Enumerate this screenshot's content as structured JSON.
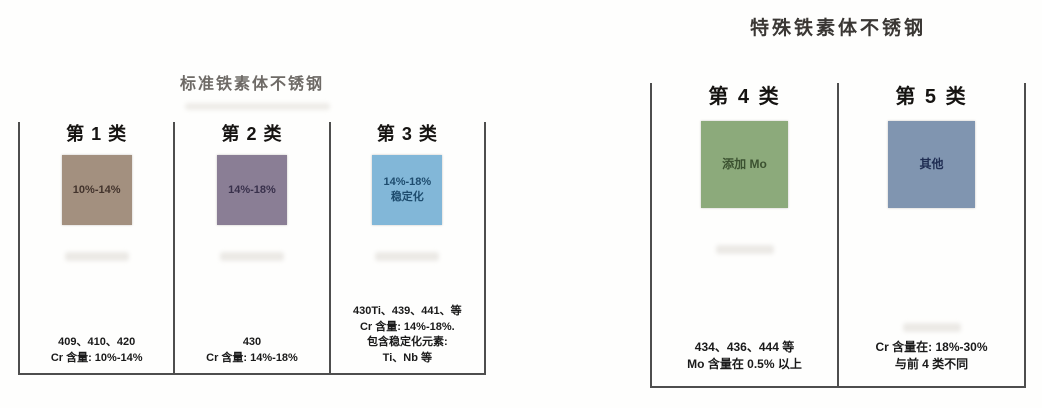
{
  "colors": {
    "panel_border": "#4e4e4e",
    "class1_box": "#a3907f",
    "class2_box": "#8a7e95",
    "class3_box": "#82b7d8",
    "class4_box": "#8caa7b",
    "class5_box": "#8095b0",
    "left_title_text": "#6e6a66",
    "right_title_text": "#3a3734"
  },
  "groups": [
    {
      "title": "标准铁素体不锈钢",
      "columns": [
        {
          "header": "第 1 类",
          "box_lines": [
            "10%-14%"
          ],
          "notes": [
            "409、410、420",
            "Cr 含量: 10%-14%"
          ]
        },
        {
          "header": "第 2 类",
          "box_lines": [
            "14%-18%"
          ],
          "notes": [
            "430",
            "Cr 含量: 14%-18%"
          ]
        },
        {
          "header": "第 3 类",
          "box_lines": [
            "14%-18%",
            "稳定化"
          ],
          "notes": [
            "430Ti、439、441、等",
            "Cr 含量: 14%-18%.",
            "包含稳定化元素:",
            "Ti、Nb 等"
          ]
        }
      ]
    },
    {
      "title": "特殊铁素体不锈钢",
      "columns": [
        {
          "header": "第 4 类",
          "box_lines": [
            "添加 Mo"
          ],
          "notes": [
            "434、436、444 等",
            "Mo 含量在 0.5% 以上"
          ]
        },
        {
          "header": "第 5 类",
          "box_lines": [
            "其他"
          ],
          "notes": [
            "Cr 含量在: 18%-30%",
            "与前 4 类不同"
          ]
        }
      ]
    }
  ]
}
